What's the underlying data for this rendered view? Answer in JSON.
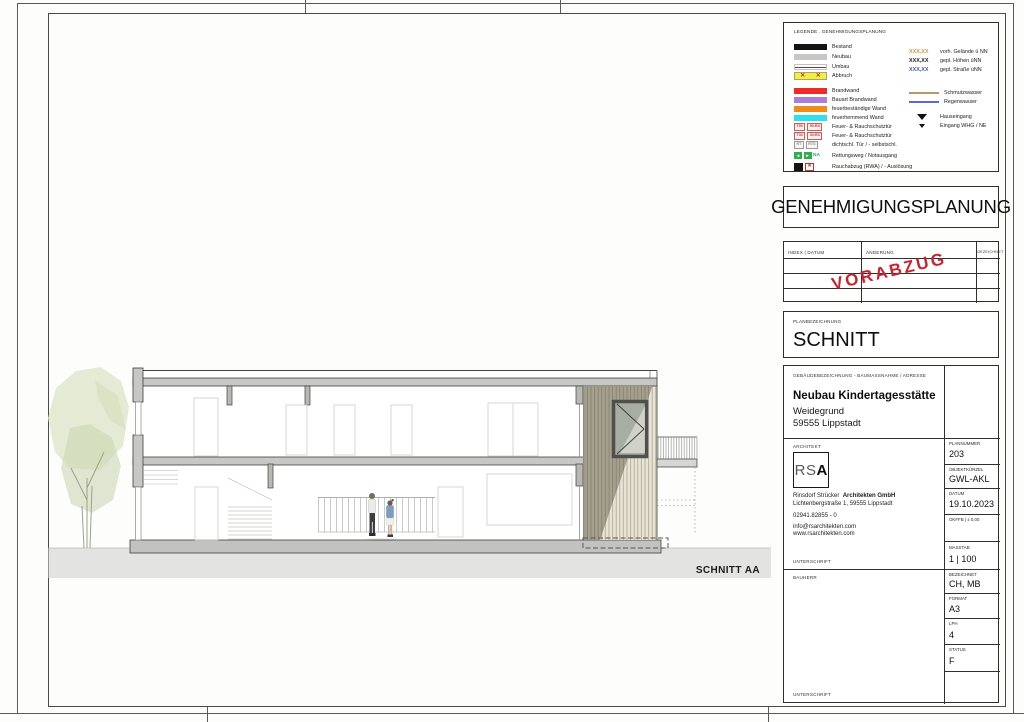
{
  "sheet": {
    "drawing_caption": "SCHNITT AA",
    "accent_color": "#c8232e"
  },
  "legend": {
    "title": "LEGENDE . GENEHMIGUNGSPLANUNG",
    "items": [
      {
        "label": "Bestand",
        "type": "bestand",
        "color": "#141414"
      },
      {
        "label": "Neubau",
        "type": "neubau",
        "color": "#c7c7c5"
      },
      {
        "label": "Umbau",
        "type": "umbau",
        "color": "#8e3434"
      },
      {
        "label": "Abbruch",
        "type": "abbruch",
        "color": "#f3ef3d"
      },
      {
        "label": "Brandwand",
        "type": "brandwand",
        "color": "#ee2b24"
      },
      {
        "label": "Bauart Brandwand",
        "type": "bauart",
        "color": "#ab7fd6"
      },
      {
        "label": "feuerbeständige Wand",
        "type": "feuerbestaendig",
        "color": "#f08c1e"
      },
      {
        "label": "feuerhemmend Wand",
        "type": "feuerhemmend",
        "color": "#2edfee"
      },
      {
        "label": "Feuer- & Rauchschutztür",
        "type": "tuer90",
        "tags": [
          "T90",
          "90-RS"
        ]
      },
      {
        "label": "Feuer- & Rauchschutztür",
        "type": "tuer30",
        "tags": [
          "T30",
          "30-RS"
        ]
      },
      {
        "label": "dichtschl. Tür / - selbstschl.",
        "type": "tuer-dicht",
        "tags": [
          "RT",
          "RTS"
        ]
      },
      {
        "label": "Rettungsweg / Notausgang",
        "type": "rettungsweg",
        "na": "NA"
      },
      {
        "label": "Rauchabzug (RWA) / - Auslösung",
        "type": "rwa",
        "x": "✕"
      }
    ],
    "levels": [
      {
        "value": "XXX,XX",
        "label": "vorh. Gelände ü NN",
        "color": "#e0963f"
      },
      {
        "value": "XXX,XX",
        "label": "gepl. Höhen üNN",
        "color": "#1a1a1a"
      },
      {
        "value": "XXX,XX",
        "label": "gepl. Straße üNN",
        "color": "#4553c8"
      }
    ],
    "pipes": [
      {
        "label": "Schmutzwasser",
        "color": "#b89a6a"
      },
      {
        "label": "Regenwasser",
        "color": "#5a68d8"
      }
    ],
    "entrances": [
      {
        "label": "Hauseingang"
      },
      {
        "label": "Eingang WHG / NE"
      }
    ]
  },
  "phase_box": {
    "title": "GENEHMIGUNGSPLANUNG"
  },
  "revision_table": {
    "col_index": "INDEX | DATUM",
    "col_change": "ÄNDERUNG",
    "col_drawn": "GEZEICHNET",
    "stamp": "VORABZUG"
  },
  "plan_title": {
    "label": "PLANBEZEICHNUNG",
    "value": "SCHNITT"
  },
  "project": {
    "label": "GEBÄUDEBEZEICHNUNG - BAUMASSNAHME / ADRESSE",
    "name": "Neubau Kindertagesstätte",
    "street": "Weidegrund",
    "city": "59555 Lippstadt"
  },
  "architect": {
    "label": "ARCHITEKT",
    "logo_rs": "RS",
    "logo_a": "A",
    "firm": "Rinsdorf Strücker",
    "firm_bold": "Architekten GmbH",
    "address": "Lichtenbergstraße 1, 59555 Lippstadt",
    "phone": "02941.82855 - 0",
    "email": "info@rsarchitekten.com",
    "web": "www.rsarchitekten.com",
    "signature_label": "UNTERSCHRIFT"
  },
  "client": {
    "label": "BAUHERR",
    "signature_label": "UNTERSCHRIFT"
  },
  "meta": [
    {
      "label": "PLANNUMMER",
      "value": "203"
    },
    {
      "label": "OBJEKTKÜRZEL",
      "value": "GWL-AKL"
    },
    {
      "label": "DATUM",
      "value": "19.10.2023"
    },
    {
      "label": "OKFFB | ± 0,00",
      "value": ""
    },
    {
      "label": "MASSTAB",
      "value": "1 | 100"
    },
    {
      "label": "BEZEICHNET",
      "value": "CH, MB"
    },
    {
      "label": "FORMAT",
      "value": "A3"
    },
    {
      "label": "LPH",
      "value": "4"
    },
    {
      "label": "STATUS",
      "value": "F"
    },
    {
      "label": "",
      "value": ""
    }
  ]
}
